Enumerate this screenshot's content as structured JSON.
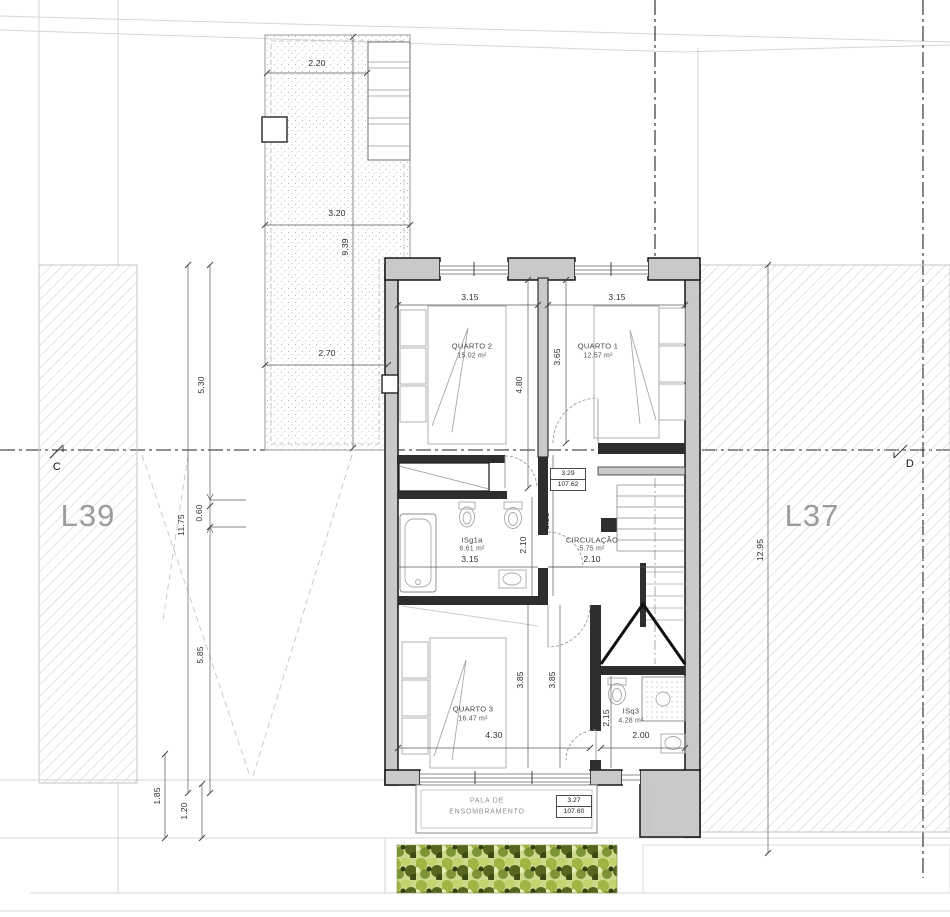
{
  "site": {
    "lot_left_label": "L39",
    "lot_right_label": "L37",
    "section_marker_left": "C",
    "section_marker_right": "D"
  },
  "rooms": {
    "quarto2": {
      "name": "QUARTO 2",
      "area": "15.02 m²"
    },
    "quarto1": {
      "name": "QUARTO 1",
      "area": "12.57 m²"
    },
    "quarto3": {
      "name": "QUARTO 3",
      "area": "16.47 m²"
    },
    "isg1a": {
      "name": "ISg1a",
      "area": "6.61 m²"
    },
    "circulacao": {
      "name": "CIRCULAÇÃO",
      "area": "5.75 m²"
    },
    "isq3": {
      "name": "ISq3",
      "area": "4.28 m²"
    }
  },
  "levels": {
    "upper": {
      "rel": "3.29",
      "abs": "107.62"
    },
    "pala": {
      "rel": "3.27",
      "abs": "107.60"
    }
  },
  "pala": {
    "line1": "PALA DE",
    "line2": "ENSOMBRAMENTO"
  },
  "dims": {
    "terrace_top": "2.20",
    "terrace_mid": "3.20",
    "terrace_height": "9.39",
    "terrace_bottom": "2.70",
    "left_upper": "5.30",
    "left_step": "0.60",
    "left_total": "11.75",
    "left_lower": "5.85",
    "left_bottom_outer": "1.85",
    "left_bottom_inner": "1.20",
    "right_total": "12.95",
    "q2_width": "3.15",
    "q1_width": "3.15",
    "q2_depth": "4.80",
    "q1_depth": "3.65",
    "hall_depth": "3.25",
    "isg1a_depth": "2.10",
    "isg1a_width": "3.15",
    "hall_width": "2.10",
    "q3_depth_left": "3.85",
    "q3_depth_right": "3.85",
    "q3_width": "4.30",
    "isq3_depth": "2.15",
    "isq3_width": "2.00"
  },
  "colors": {
    "wall_fill": "#c9c9c9",
    "wall_outline": "#1a1a1a",
    "partition": "#2e2e2e",
    "hatch_line": "#c9c9c9",
    "vegetation_light": "#c3d46f",
    "vegetation_dark": "#55671f",
    "lot_label": "#9c9c9c"
  }
}
